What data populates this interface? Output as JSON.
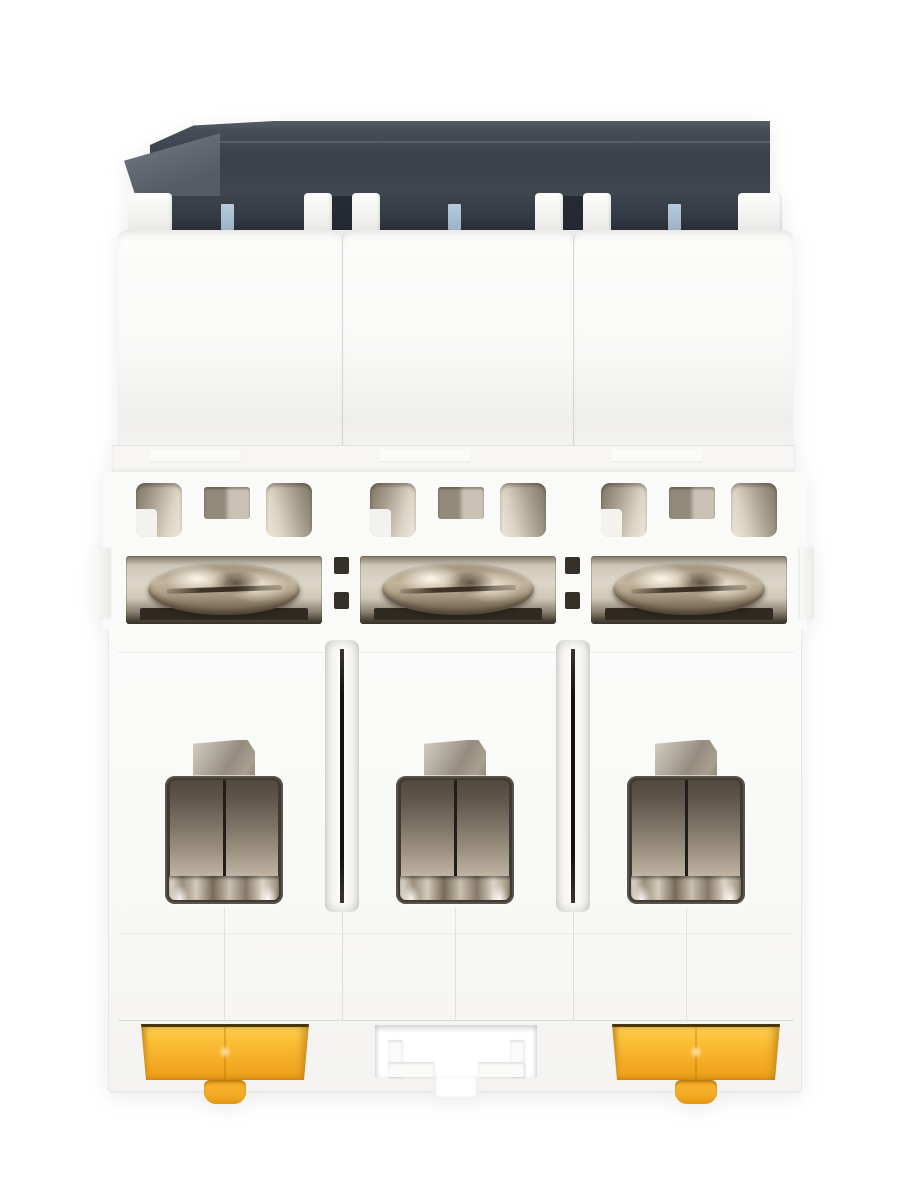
{
  "meta": {
    "domain": "Natural-Image",
    "subject": "Three-pole DIN-rail miniature circuit breaker photographed from the bottom terminal side",
    "background": "plain white studio background",
    "visible_text": "none"
  },
  "device": {
    "pole_count": 3,
    "din_rail_clip_count": 2,
    "terminal_screw_count": 3,
    "terminal_clamp_count": 3,
    "vent_openings_per_pole": 3,
    "label_window_count": 3,
    "parts": {
      "top_cap": "dark charcoal plastic cap at top",
      "label_windows": "three small blue-grey windows under the cap, one per pole",
      "upper_modules": "three white housing modules separated by seams",
      "vent_band": "row of rounded vent openings and square slots",
      "terminal_screws": "three nickel dome screw heads seen edge-on in recesses",
      "inter_pole_slots": "two vertical separator slots with dark slits",
      "terminal_clamps": "three open terminal cavities with metal clamp plates",
      "din_rail_clips": "two yellow spring clips on outer poles",
      "din_rail_cutout": "stepped rectangular cutout on middle pole"
    }
  },
  "colors": {
    "bg": "#ffffff",
    "cap_top": "#4a505a",
    "cap_mid": "#3c424c",
    "cap_deep": "#272c35",
    "cap_wedge": "#747a84",
    "cap_bar": "#23272f",
    "window_blue_1": "#b6cadc",
    "window_blue_2": "#9cb2c7",
    "body_1": "#fcfcfb",
    "body_2": "#f0efed",
    "seam": "#d8d7d4",
    "vent_dark": "#7e7666",
    "vent_light": "#efe9dd",
    "recess_1": "#7d7565",
    "recess_2": "#ddd6c8",
    "recess_3": "#38322a",
    "dome_1": "#c3b49c",
    "dome_2": "#6b5f4c",
    "plate_1": "#51483e",
    "plate_2": "#c3b8a7",
    "slit": "#16130f",
    "clip_1": "#ffd053",
    "clip_2": "#f6b02a",
    "clip_3": "#e89a16",
    "clip_edge": "#4a3606",
    "tab_metal_1": "#d2ccc2",
    "tab_metal_2": "#948c7e"
  }
}
